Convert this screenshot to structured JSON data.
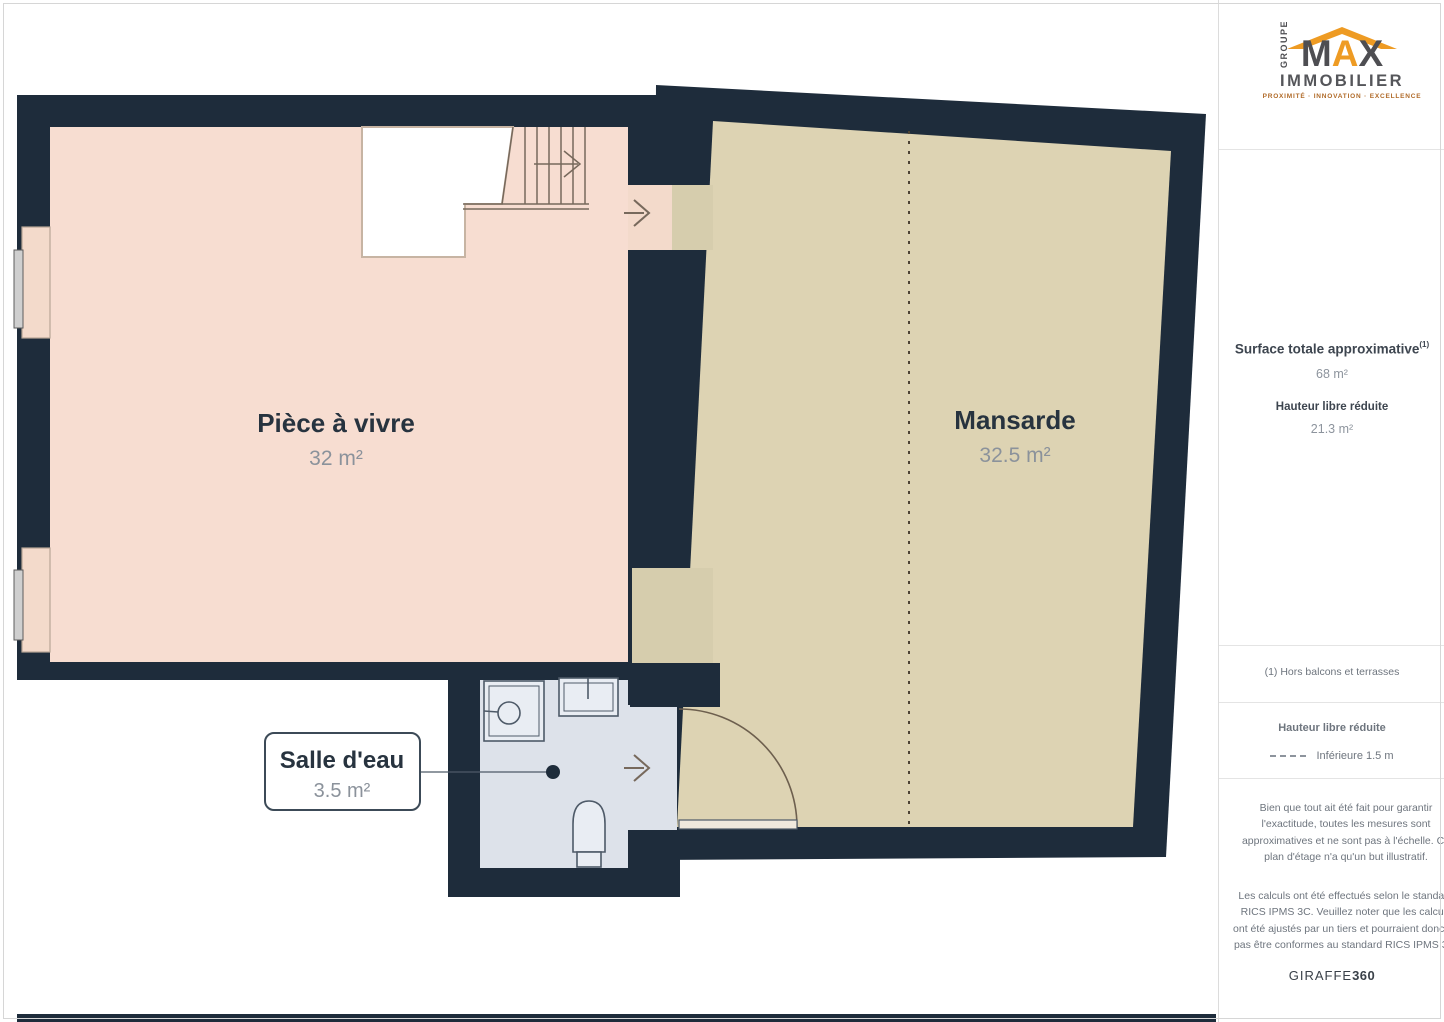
{
  "logo": {
    "groupe": "GROUPE",
    "max_m": "M",
    "max_a": "A",
    "max_x": "X",
    "immobilier": "IMMOBILIER",
    "tagline": "PROXIMITÉ · INNOVATION · EXCELLENCE"
  },
  "sidebar": {
    "surface_label": "Surface totale approximative",
    "surface_sup": "(1)",
    "surface_value": "68 m²",
    "hauteur_label": "Hauteur libre réduite",
    "hauteur_value": "21.3 m²",
    "footnote": "(1) Hors balcons et terrasses",
    "legend_title": "Hauteur libre réduite",
    "legend_item": "Inférieure 1.5 m",
    "disclaimer1": "Bien que tout ait été fait pour garantir l'exactitude, toutes les mesures sont approximatives et ne sont pas à l'échelle. Ce plan d'étage n'a qu'un but illustratif.",
    "disclaimer2": "Les calculs ont été effectués selon le standard RICS IPMS 3C. Veuillez noter que les calculs ont été ajustés par un tiers et pourraient donc ne pas être conformes au standard RICS IPMS 3C.",
    "brand": "GIRAFFE",
    "brand_bold": "360"
  },
  "plan": {
    "rooms": [
      {
        "name": "Pièce à vivre",
        "area": "32 m²"
      },
      {
        "name": "Mansarde",
        "area": "32.5 m²"
      },
      {
        "name": "Salle d'eau",
        "area": "3.5 m²"
      }
    ],
    "colors": {
      "wall": "#1e2c3b",
      "living_floor": "#f7ddd1",
      "mansarde_floor": "#ddd3b3",
      "passage_floor": "#d6cdad",
      "bathroom_floor": "#dde2ea",
      "fixture_fill": "#e9edf3",
      "logo_orange": "#ee9b23"
    }
  }
}
